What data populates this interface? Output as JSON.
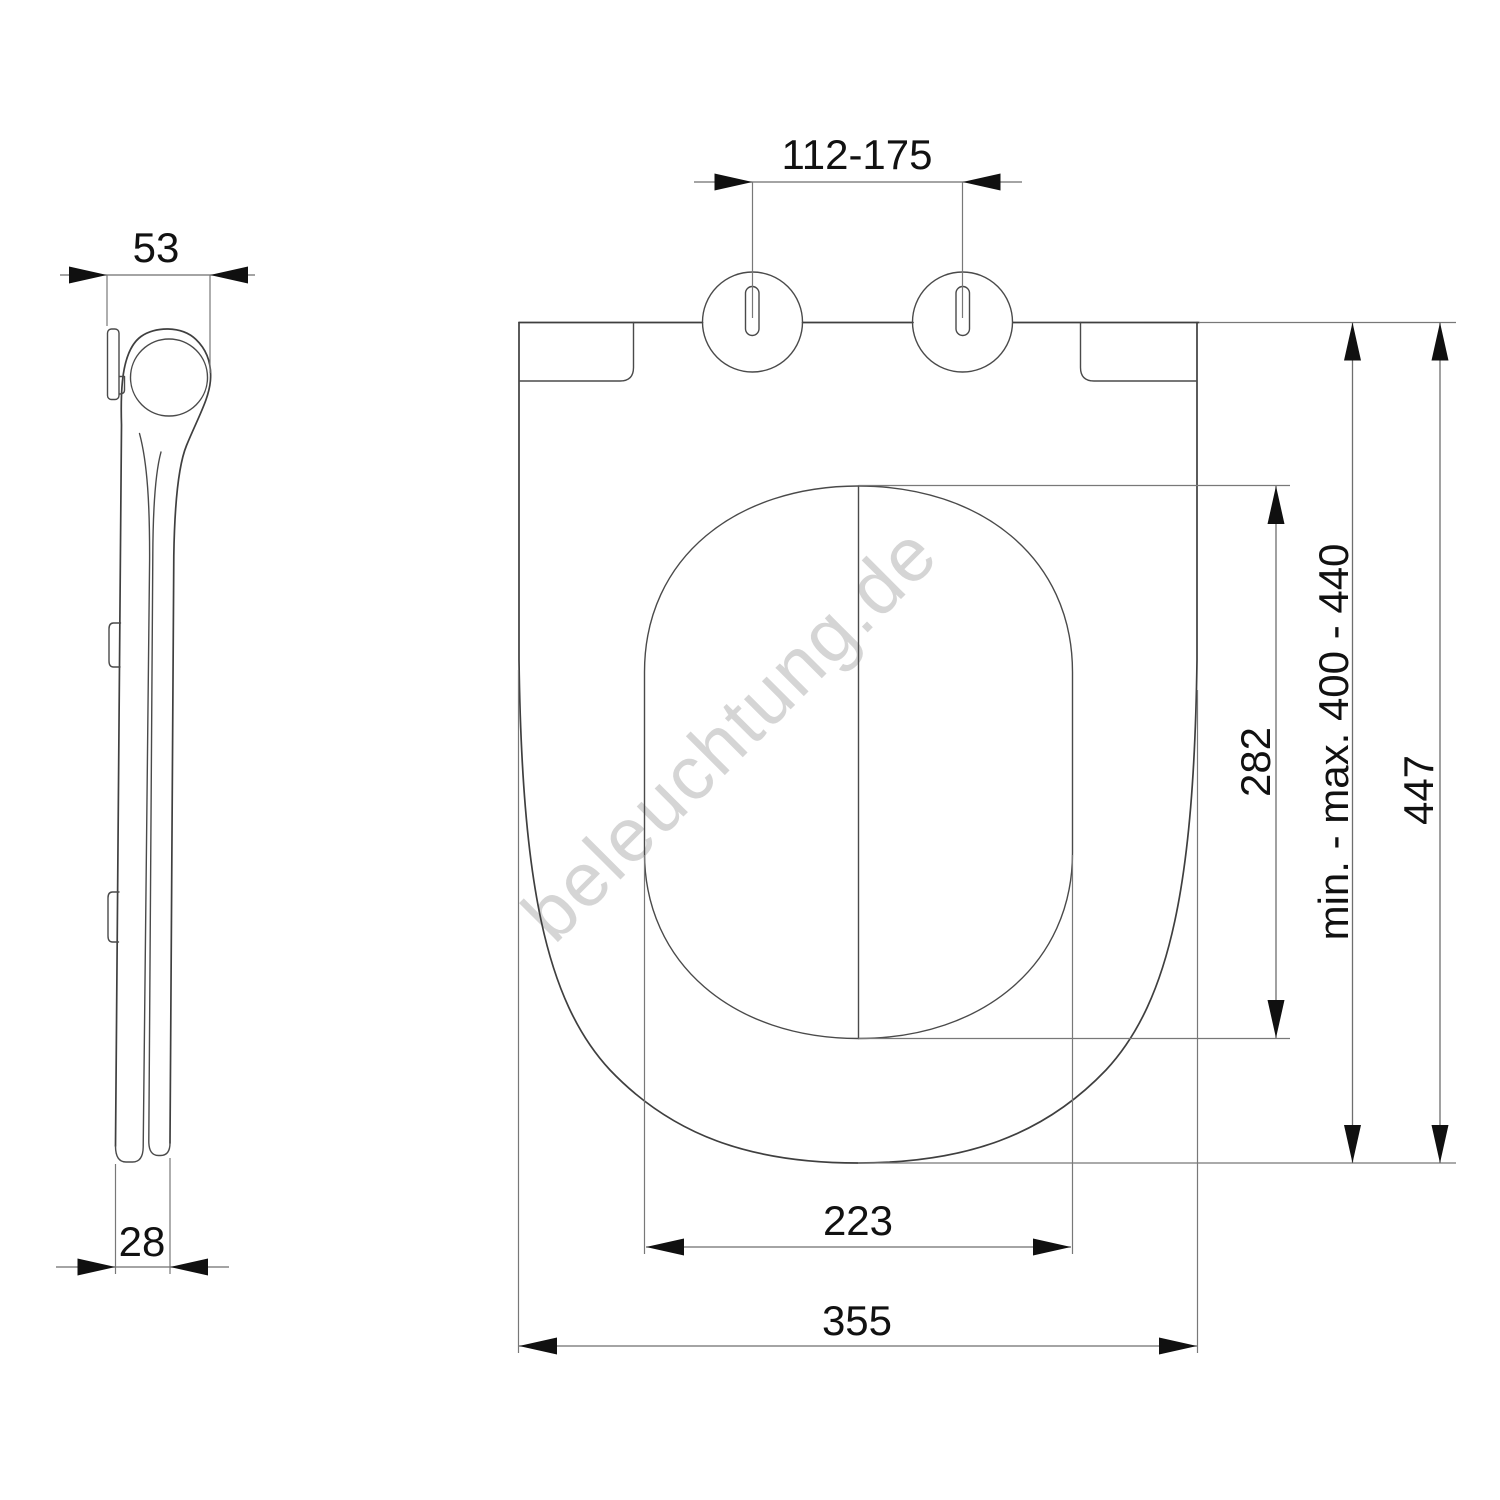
{
  "watermark": "beleuchtung.de",
  "dimensions": {
    "top_view": {
      "hinge_spacing": "112-175",
      "inner_width": "223",
      "outer_width": "355",
      "inner_length": "282",
      "mount_range": "min. - max. 400 - 440",
      "outer_length": "447"
    },
    "side_view": {
      "top_thickness": "53",
      "bottom_thickness": "28"
    }
  },
  "colors": {
    "line": "#3f3f3f",
    "dimension_line": "#6e6e6e",
    "arrow": "#101010",
    "text": "#111111",
    "watermark": "#cbcbcb",
    "background": "#ffffff"
  }
}
